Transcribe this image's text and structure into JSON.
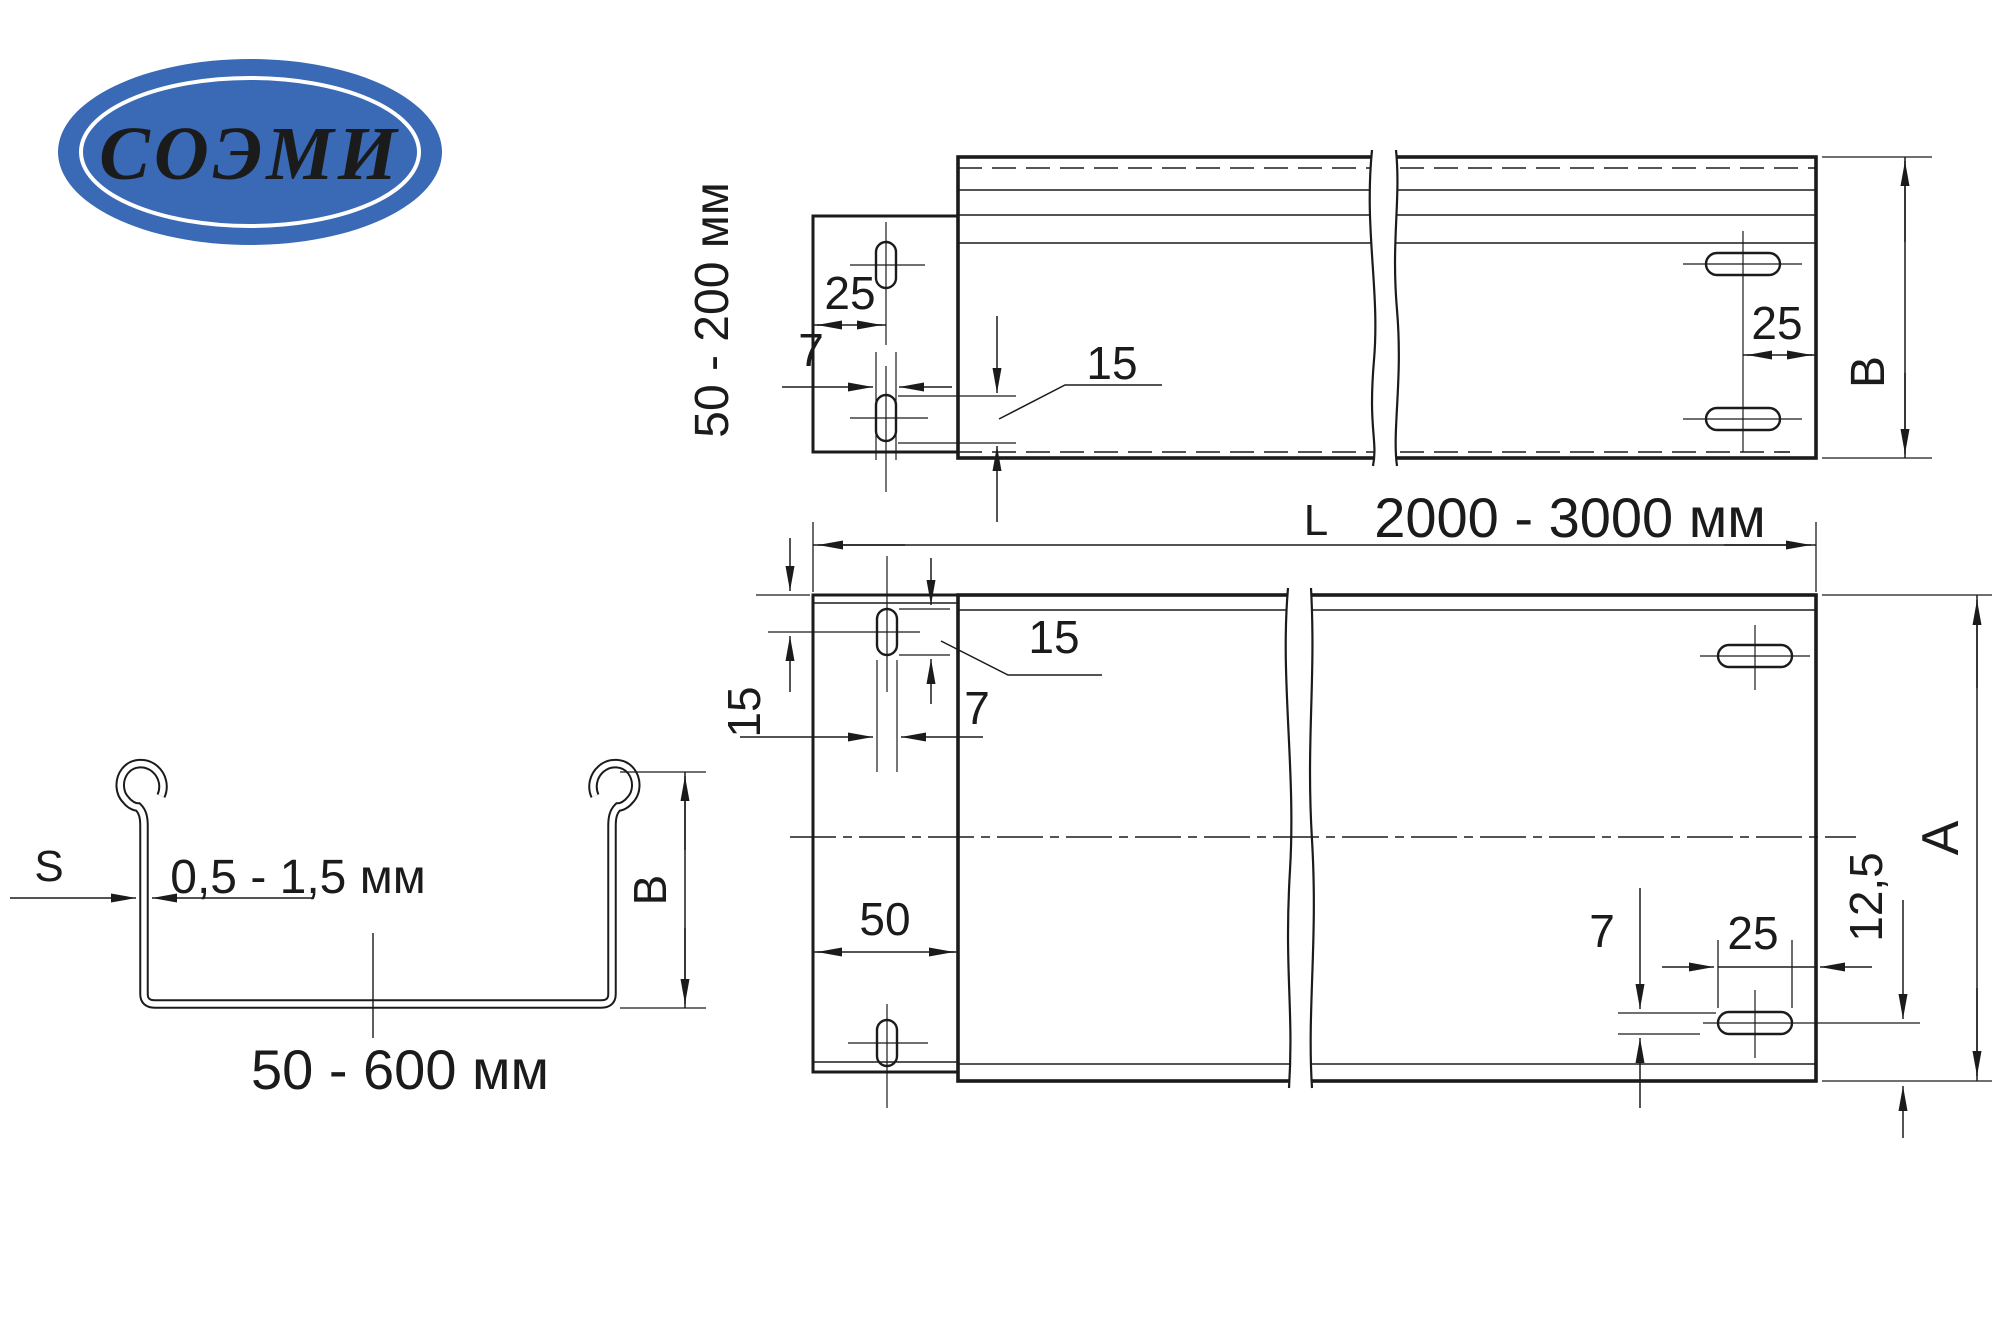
{
  "logo": {
    "text": "СОЭМИ",
    "ellipse_color": "#3a69b5"
  },
  "side_view": {
    "height_range_label": "50 - 200 мм",
    "dim_tab_hole_offset": "25",
    "dim_slot_width": "7",
    "dim_slot_length": "15",
    "dim_right_hole_offset": "25",
    "dim_height": "B"
  },
  "plan_view": {
    "length_prefix": "L",
    "length_range_label": "2000 - 3000 мм",
    "dim_top_hole_offset": "15",
    "dim_slot_length": "15",
    "dim_slot_width": "7",
    "dim_tab_protrusion": "50",
    "dim_right_slot_width": "7",
    "dim_right_hole_offset": "25",
    "dim_bottom_hole_offset": "12,5",
    "dim_width": "A"
  },
  "section_view": {
    "thickness_symbol": "S",
    "thickness_range_label": "0,5 - 1,5 мм",
    "dim_height": "B",
    "width_range_label": "50 - 600 мм"
  }
}
